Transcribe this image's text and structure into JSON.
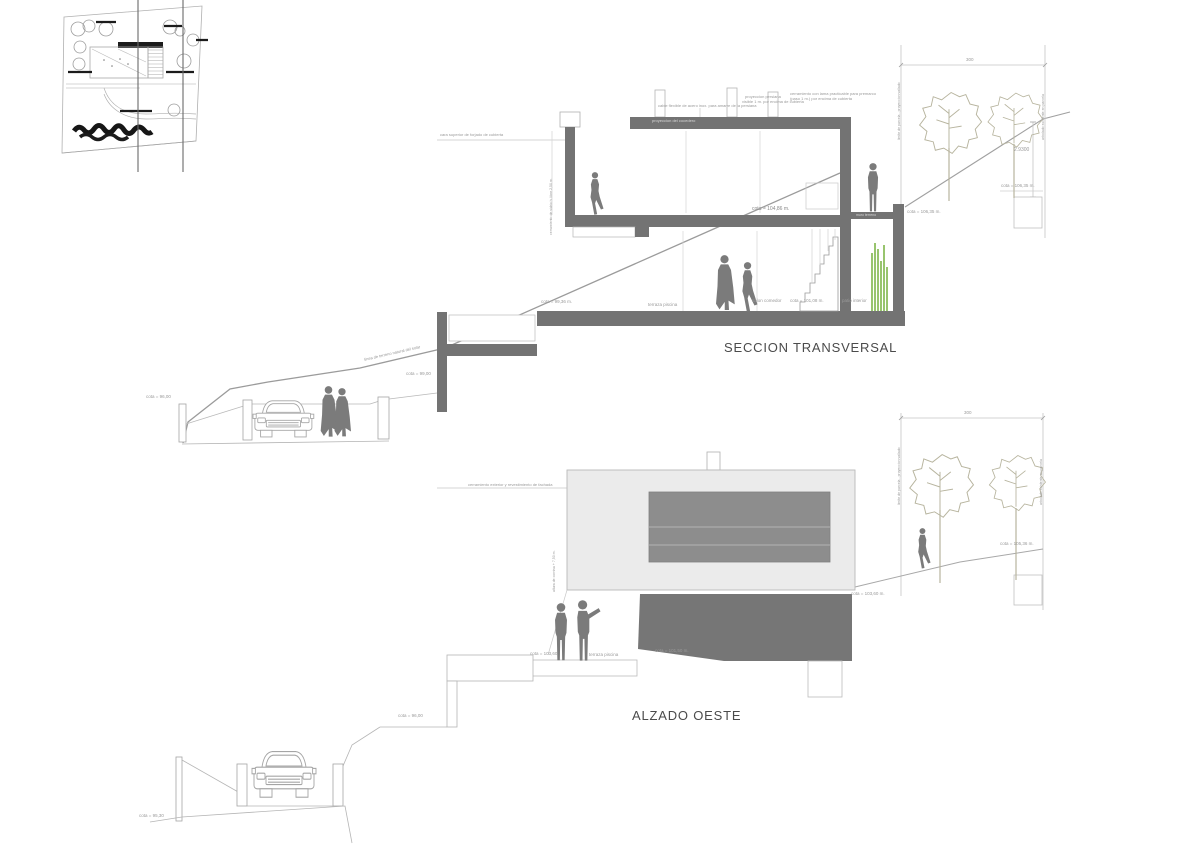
{
  "section": {
    "title": "SECCION TRANSVERSAL",
    "labels": {
      "roof_band": "proyeccion del cocedero",
      "cable": "cable flexible de acero inox. para amarre de la persiana",
      "persiana_1": "proyeccion persiana",
      "persiana_2": "visible 1 m. por encima de cubierta",
      "lama_1": "cerramiento con lama practicable para premarco",
      "lama_2": "(paso 1 m.) por encima de cubierta",
      "slab_left": "cara superior de forjado de cubierta",
      "wall_left_rot": "cerramiento de vidrio h. libre 2,50 m.",
      "upper_cota": "cota = 104,86 m.",
      "muro": "muro terreno",
      "wall_cota": "cota = 106,35 m.",
      "floor_cota": "cota = 99,36 m.",
      "terraza": "terraza piscina",
      "salon": "salon comedor",
      "salon_cota": "cota = 101,08 m.",
      "patio": "patio interior",
      "slope_rot": "linea de terreno natural del solar",
      "cota_99": "cota = 99,00",
      "cota_96": "cota = 96,00",
      "dim_300": "300",
      "dim_alt": "2.9300",
      "tree_cota": "cota = 106,35 m.",
      "boundary_left": "limite de parcela - proyeccion vallado",
      "boundary_right": "arbolado existente en parcela"
    }
  },
  "elevation": {
    "title": "ALZADO OESTE",
    "labels": {
      "facade_line": "cerramiento exterior y revestimiento de fachada",
      "edge_rot": "altura de cornisa + 7,50 m.",
      "cota_left": "cota = 103,60",
      "terraza": "terraza piscina",
      "cota_mass": "cota = 101,50 m.",
      "cota_right": "cota = 103,60 m.",
      "tree_cota": "cota = 105,36 m.",
      "dim_300": "300",
      "boundary_left": "limite de parcela - proyeccion vallado",
      "boundary_right": "arbolado existente en parcela",
      "cota_96": "cota = 96,00"
    }
  },
  "street": {
    "cota_9530": "cota = 95,30"
  },
  "colors": {
    "cut_fill": "#737373",
    "line_light": "#b5b5b5",
    "silhouette": "#7b7b7b",
    "plant_green": "#7fb54a",
    "text": "#9a9a9a"
  }
}
